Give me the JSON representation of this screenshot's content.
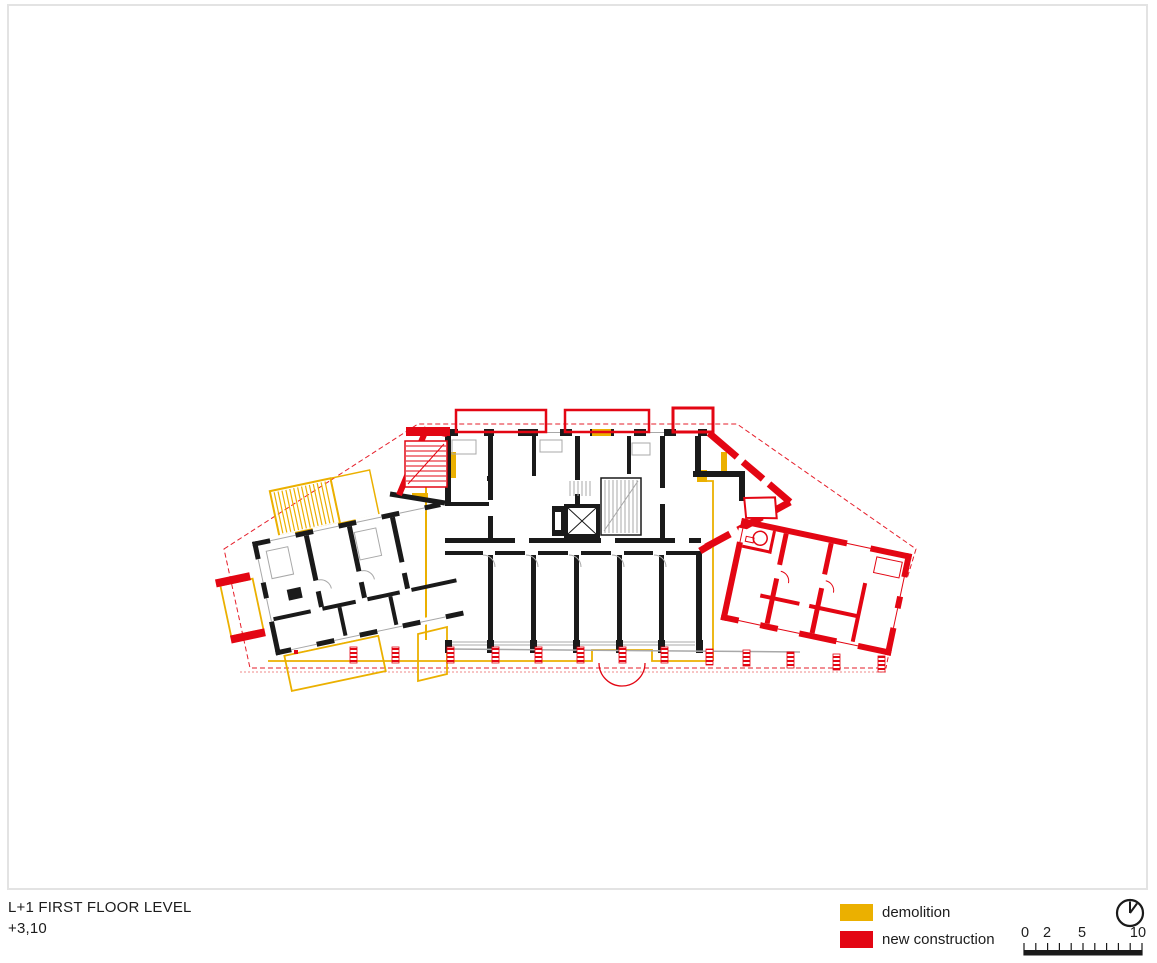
{
  "sheet": {
    "background": "#ffffff",
    "frame_color": "#e3e3e3"
  },
  "title_block": {
    "level": "L+1 FIRST FLOOR LEVEL",
    "elevation": "+3,10"
  },
  "legend": {
    "items": [
      {
        "label": "demolition",
        "color": "#ebb000"
      },
      {
        "label": "new construction",
        "color": "#e30613"
      }
    ]
  },
  "north_indicator": {
    "icon": "clock-north-icon"
  },
  "scale_bar": {
    "labels": [
      "0",
      "2",
      "5",
      "10"
    ],
    "tick_count": 11
  },
  "plan_colors": {
    "existing_walls": "#1a1a1a",
    "demolition": "#ebb000",
    "new_construction": "#e30613",
    "detail_lines": "#a8a8a8",
    "site_outline_dashed": "#e30613"
  }
}
